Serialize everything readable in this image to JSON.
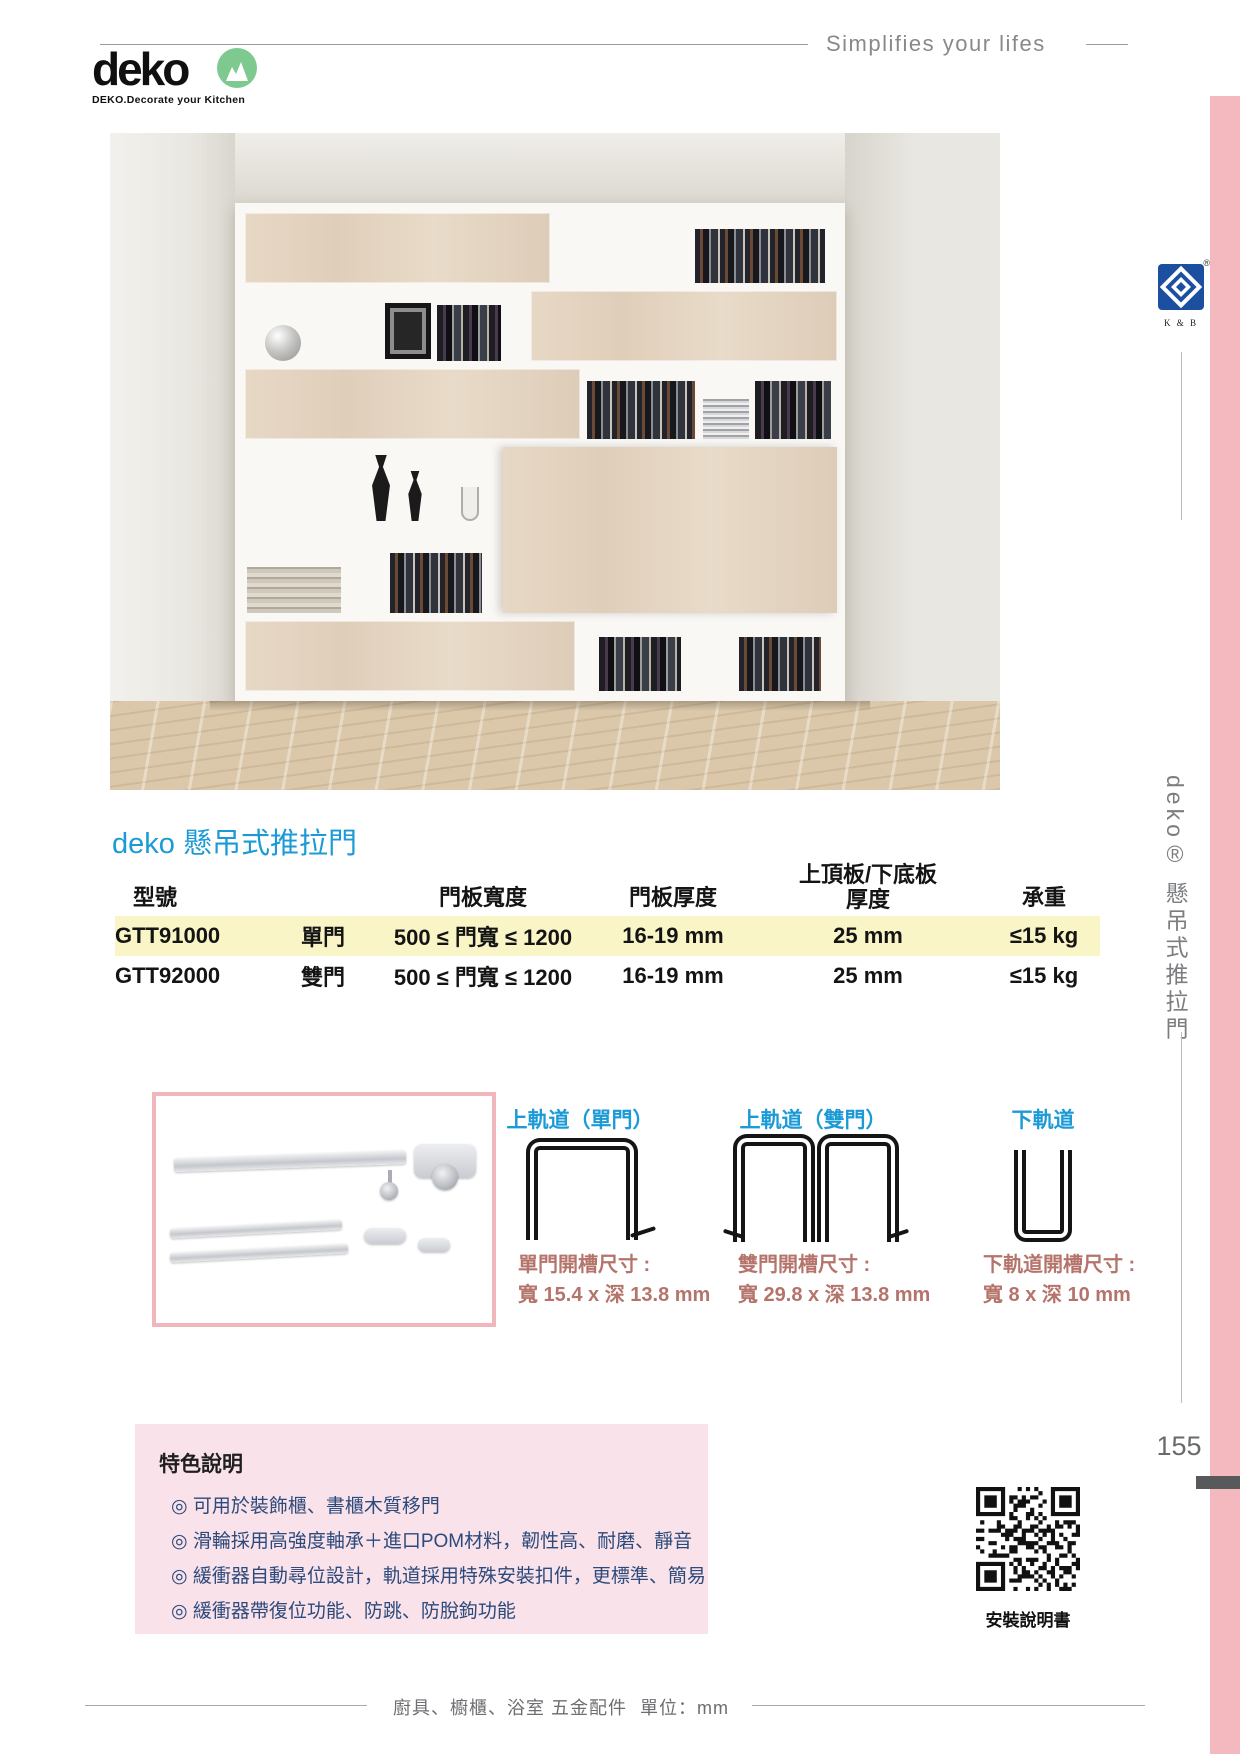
{
  "header": {
    "slogan": "Simplifies your lifes",
    "logo_text": "deko",
    "logo_tagline": "DEKO.Decorate your Kitchen"
  },
  "sidebar": {
    "kb_logo_label": "K & B",
    "kb_registered": "®",
    "vertical_title": "deko® 懸吊式推拉門",
    "page_number": "155"
  },
  "section": {
    "title": "deko 懸吊式推拉門"
  },
  "spec_table": {
    "columns": [
      {
        "label": "型號"
      },
      {
        "label": ""
      },
      {
        "label": "門板寬度"
      },
      {
        "label": "門板厚度"
      },
      {
        "label_line1": "上頂板/下底板",
        "label_line2": "厚度"
      },
      {
        "label": "承重"
      }
    ],
    "rows": [
      {
        "model": "GTT91000",
        "door_type": "單門",
        "door_width": "500 ≤ 門寬 ≤ 1200",
        "door_thickness": "16-19 mm",
        "board_thickness": "25 mm",
        "load": "≤15 kg"
      },
      {
        "model": "GTT92000",
        "door_type": "雙門",
        "door_width": "500 ≤ 門寬 ≤ 1200",
        "door_thickness": "16-19 mm",
        "board_thickness": "25 mm",
        "load": "≤15 kg"
      }
    ]
  },
  "tracks": [
    {
      "title": "上軌道（單門）",
      "caption_title": "單門開槽尺寸 :",
      "caption_value": "寬 15.4 x 深 13.8 mm"
    },
    {
      "title": "上軌道（雙門）",
      "caption_title": "雙門開槽尺寸 :",
      "caption_value": "寬 29.8 x 深 13.8 mm"
    },
    {
      "title": "下軌道",
      "caption_title": "下軌道開槽尺寸 :",
      "caption_value": "寬 8 x 深 10 mm"
    }
  ],
  "features": {
    "title": "特色說明",
    "items": [
      "◎ 可用於裝飾櫃、書櫃木質移門",
      "◎ 滑輪採用高強度軸承＋進口POM材料，韌性高、耐磨、靜音",
      "◎ 緩衝器自動尋位設計，軌道採用特殊安裝扣件，更標準、簡易",
      "◎ 緩衝器帶復位功能、防跳、防脫鉤功能"
    ]
  },
  "qr": {
    "label": "安裝說明書"
  },
  "footer": {
    "category": "廚具、櫥櫃、浴室 五金配件",
    "unit_label": "單位：mm"
  },
  "colors": {
    "accent_blue": "#1b9ad6",
    "highlight_yellow": "#faf5c6",
    "caption_brown": "#b5746b",
    "feature_box_bg": "#f9e2e9",
    "feature_text": "#2c4a7c",
    "edge_pink": "#f3b9be",
    "logo_green": "#7dc98f",
    "kb_blue": "#1c4f9f"
  }
}
